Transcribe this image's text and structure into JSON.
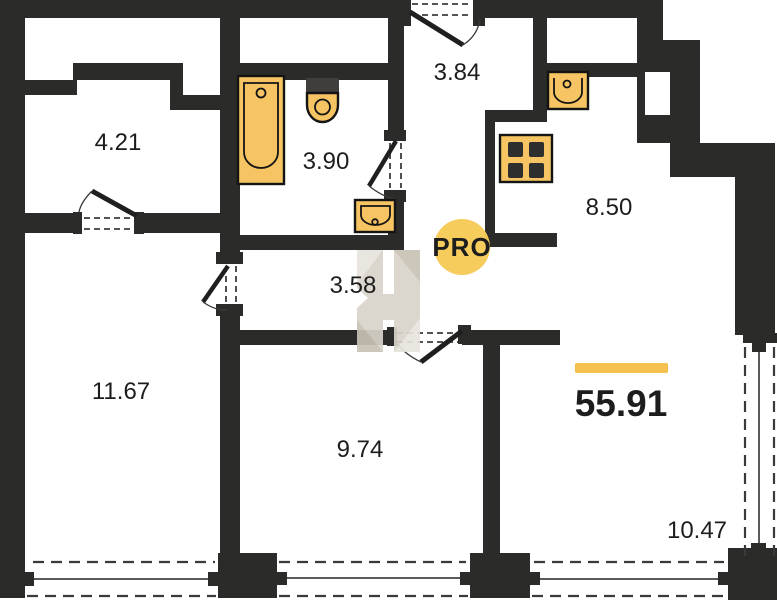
{
  "plan": {
    "title": "apartment-floor-plan",
    "total_area": "55.91",
    "rooms": [
      {
        "id": "room-top-left",
        "area": "4.21"
      },
      {
        "id": "bathroom",
        "area": "3.90"
      },
      {
        "id": "entry-hall",
        "area": "3.84"
      },
      {
        "id": "kitchen",
        "area": "8.50"
      },
      {
        "id": "corridor",
        "area": "3.58"
      },
      {
        "id": "room-left",
        "area": "11.67"
      },
      {
        "id": "room-middle",
        "area": "9.74"
      },
      {
        "id": "living-loggia",
        "area": "10.47"
      }
    ]
  },
  "watermark": {
    "badge": "PRO"
  },
  "colors": {
    "wall": "#2b2b29",
    "fixture": "#f6c462",
    "fixture_border": "#141414",
    "accent_bar": "#f5c04e",
    "badge": "#f6ca57",
    "badge_text": "#d8cca4",
    "watermark_gray": "#d8d3ca",
    "watermark_light": "#e8e4dd",
    "watermark_dark": "#c9c2b6"
  }
}
